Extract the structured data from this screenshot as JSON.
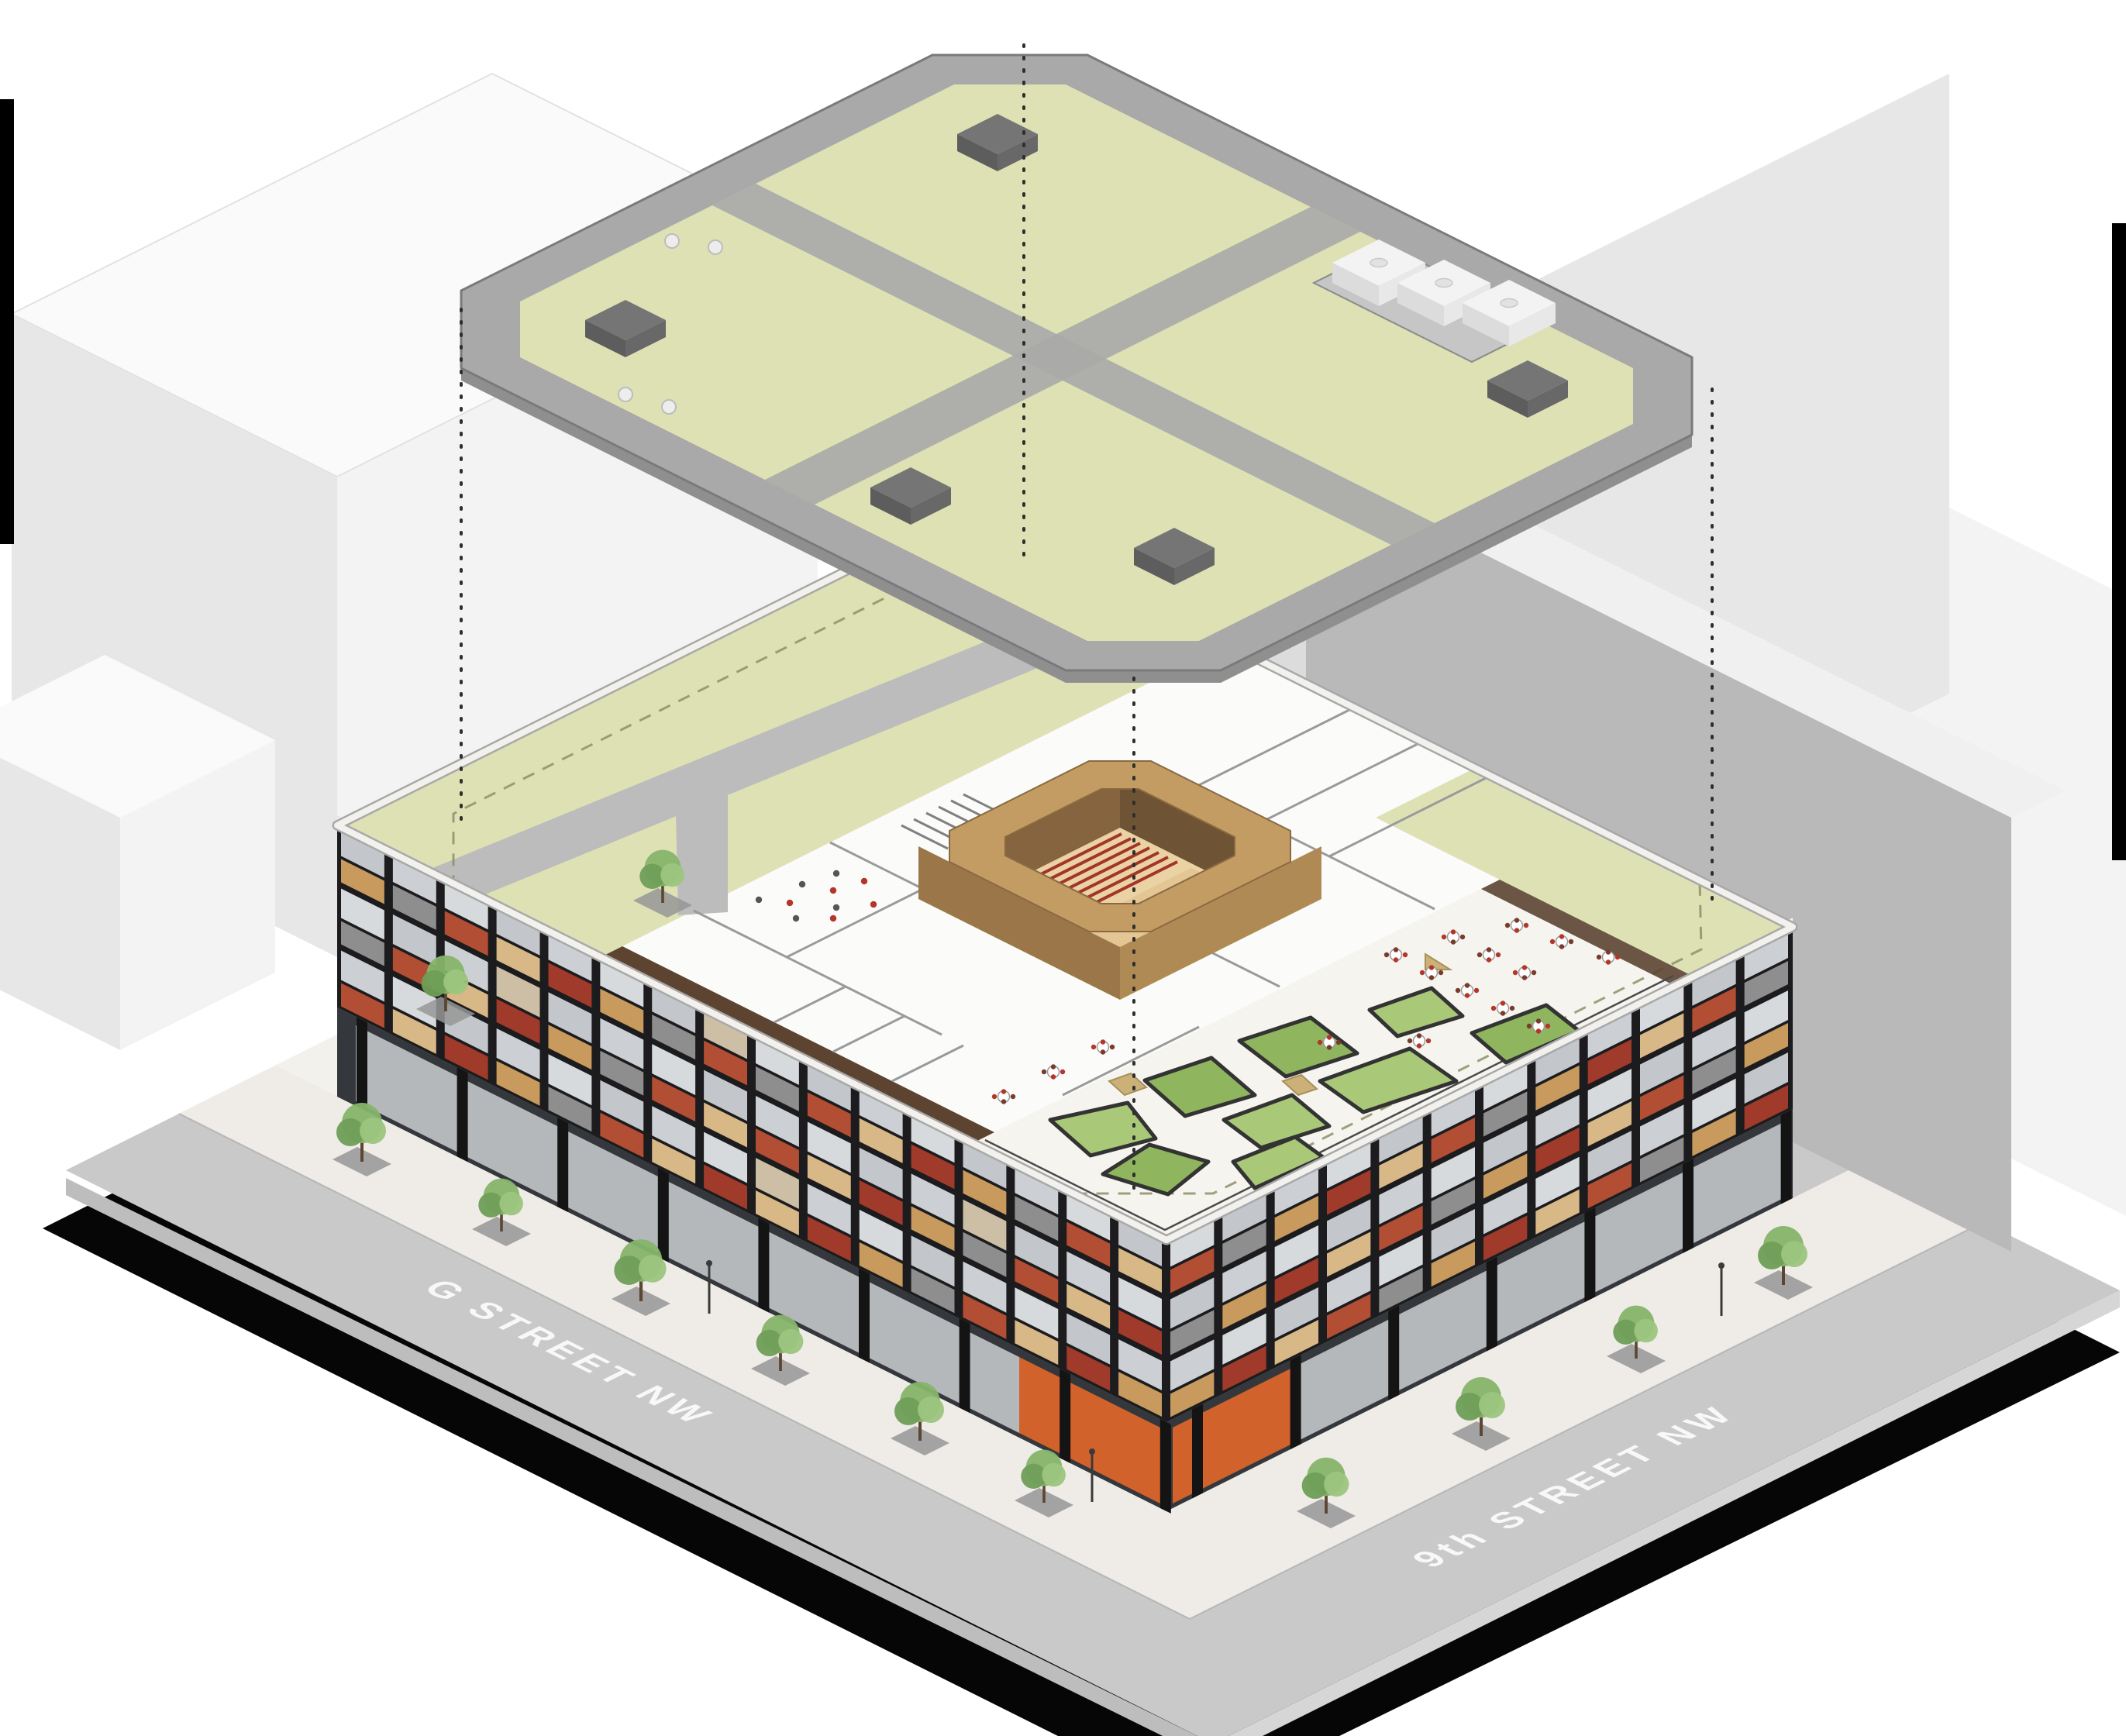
{
  "streets": {
    "g_street": "G STREET NW",
    "ninth_street": "9th STREET NW"
  },
  "palette": {
    "background": "#ffffff",
    "border_black": "#000000",
    "shadow": "#060606",
    "street": "#c9c9c9",
    "street_side_l": "#bdbdbd",
    "street_side_r": "#d6d6d6",
    "sidewalk": "#efece7",
    "plaza": "#f3f1ec",
    "tree_pit": "#979797",
    "label_text": "#fafafa",
    "context_white": "#f3f3f3",
    "context_white_side": "#e7e7e7",
    "context_top": "#fafafa",
    "context_gray": "#b9b9b9",
    "context_gray_side": "#dcdcdc",
    "context_gray_top": "#f0f0f0",
    "facade_dark": "#1c1c1f",
    "fascia": "#f2f1ed",
    "facade_panels": [
      "#b24e33",
      "#c89a5e",
      "#d9b887",
      "#8e8e8e",
      "#a03a2a"
    ],
    "glass_tints": [
      "#ccd0d4",
      "#d7dadd",
      "#c3c7cb"
    ],
    "interior_tan": "#cdbfa5",
    "ground_void": "#34373b",
    "storefront_glass": "#c3c7c9",
    "storefront_orange": "#d2622b",
    "column_black": "#141414",
    "roof_base": "#efeeea",
    "lawn": "#dde1b4",
    "floor_white": "#fbfbfa",
    "terrace": "#f6f4ef",
    "path_gray": "#bcbcbc",
    "dash_olive": "#8f8f68",
    "wall_gray": "#9a9a9a",
    "stair_gray": "#808080",
    "wood_dark": "#5c4431",
    "aud_ring": "#c29c63",
    "aud_wall_sw": "#9a7648",
    "aud_wall_se": "#b08a55",
    "aud_inner_far": "#6f5335",
    "aud_inner_side": "#85643f",
    "aud_floor": "#ead2a4",
    "aud_stage": "#e3c693",
    "seat_red": "#a3342a",
    "planter_a": "#a9c878",
    "planter_b": "#8fb55e",
    "planter_edge": "#333333",
    "bench_tan": "#cbb078",
    "railing": "#4a4a4a",
    "chair_red": "#b3362b",
    "chair_dark": "#7a3b2d",
    "table_white": "#ffffff",
    "table_edge": "#9a9a9a",
    "ring_gray": "#a9a9a9",
    "ring_edge": "#7a7a7a",
    "plate_side": "#8f8f8f",
    "roof_lawn": "#dde1b4",
    "mech_well": "#c6c6c6",
    "mech_dark_top": "#757575",
    "mech_dark_left": "#5d5d5d",
    "mech_dark_right": "#686868",
    "unit_white_top": "#f3f3f3",
    "unit_white_left": "#dcdcdc",
    "unit_white_right": "#e8e8e8",
    "unit_circle": "#e2e2e2",
    "dotted_line": "#2e2e2e",
    "tree_greens": [
      "#86b46a",
      "#6f9e57",
      "#9cc57e"
    ],
    "trunk": "#5a4632",
    "lamp": "#3a3a3a",
    "people_dot_a": "#b3362b",
    "people_dot_b": "#555555"
  }
}
